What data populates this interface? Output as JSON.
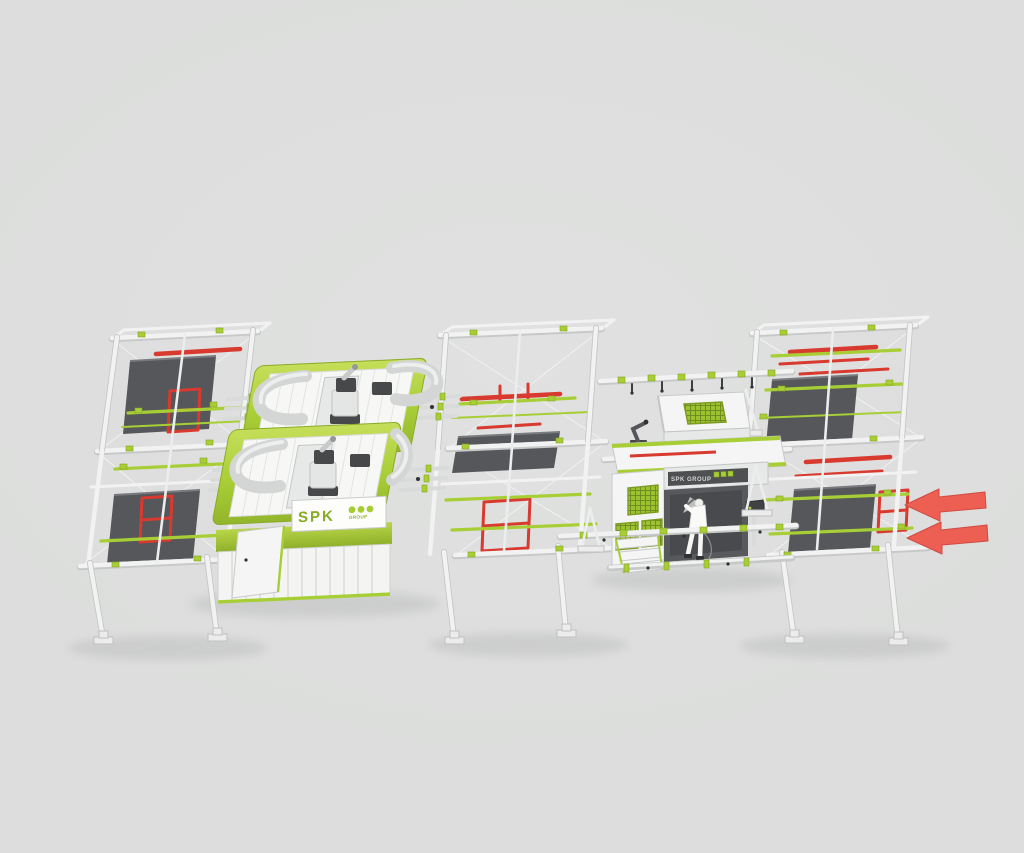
{
  "branding": {
    "booth_logo": {
      "text": "SPK",
      "subtext": "GROUP",
      "dot_count": 3
    },
    "station_label": {
      "text": "SPK GROUP",
      "square_count": 3
    }
  },
  "flow_indicator": {
    "arrow_count": 2,
    "direction": "left"
  },
  "colors": {
    "background": "#dcdddc",
    "brand_green": "#a8ce36",
    "brand_green_light": "#c6de5a",
    "brand_green_dark": "#8aab26",
    "carrier_red": "#d93a2f",
    "arrow_red": "#ed5f53",
    "arrow_red_edge": "#d04b41",
    "frame_white": "#f1f2f1",
    "frame_shade": "#c2c4c5",
    "panel_dark": "#55575a",
    "metal_gray": "#d4d6d6"
  }
}
